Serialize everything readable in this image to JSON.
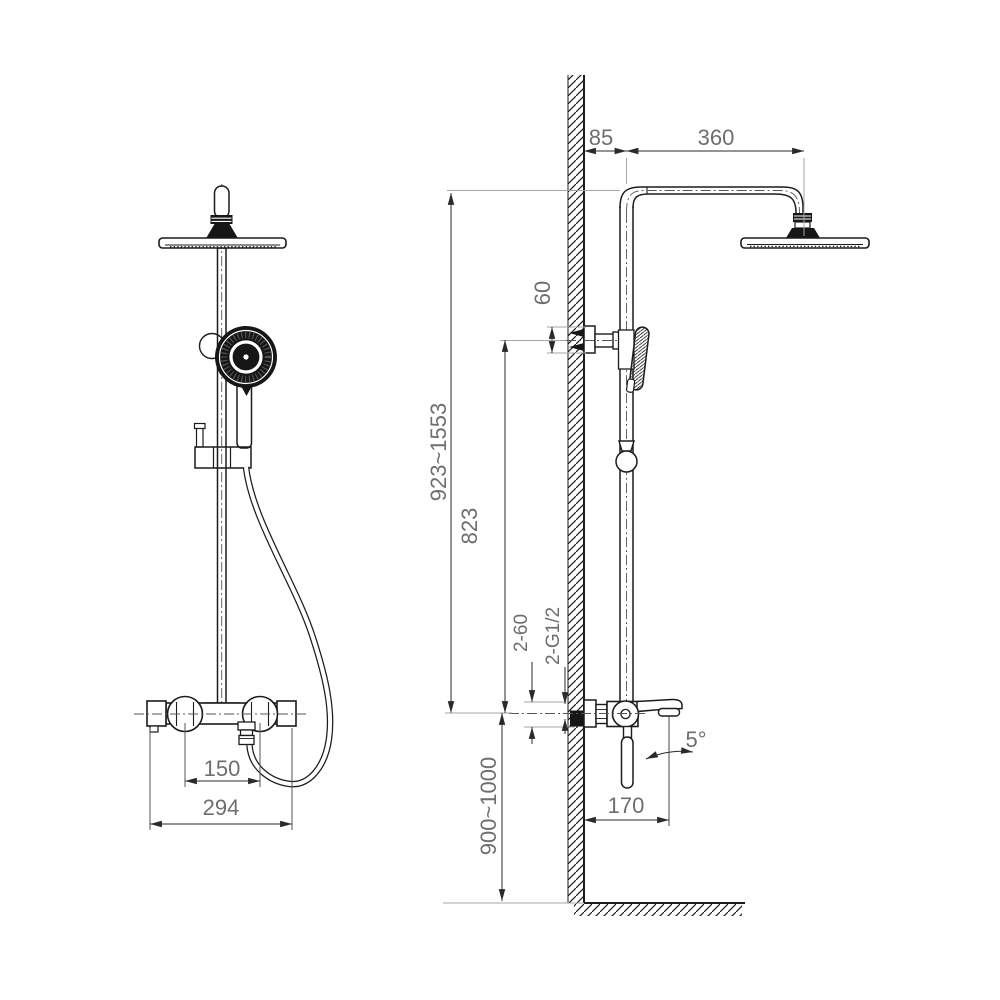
{
  "front_view": {
    "holder_spacing": "150",
    "overall_width": "294"
  },
  "side_view": {
    "wall_offset": "85",
    "arm_reach": "360",
    "bracket_height": "60",
    "height_range": "923~1553",
    "bracket_to_mixer": "823",
    "inlet_spacing": "2-60",
    "inlet_thread": "2-G1/2",
    "spout_angle": "5°",
    "spout_reach": "170",
    "install_height": "900~1000"
  },
  "colors": {
    "line": "#1c1c1c",
    "dimension_text": "#6e6e6e",
    "extension_line": "#a6a6a6",
    "background": "#ffffff",
    "dark_fill": "#161616"
  }
}
